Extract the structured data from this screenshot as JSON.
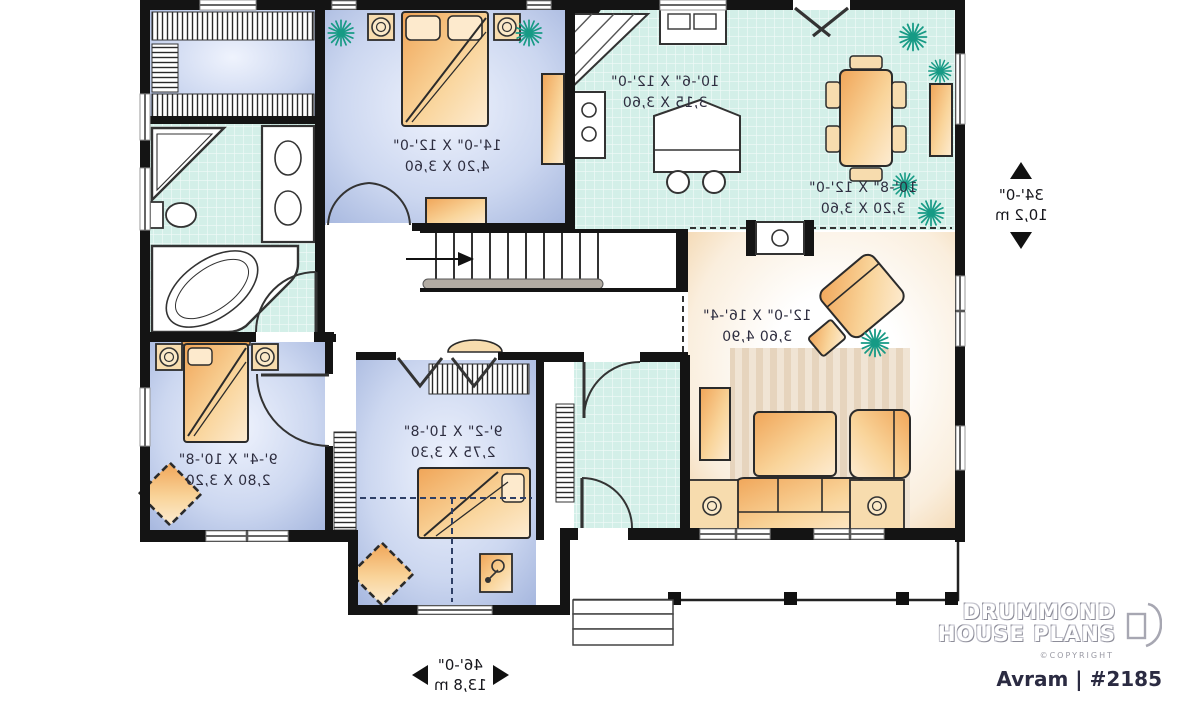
{
  "plan": {
    "brand": {
      "line1": "DRUMMOND",
      "line2": "HOUSE PLANS",
      "copyright": "©COPYRIGHT",
      "model": "Avram | #2185"
    },
    "dimensions": {
      "depth_ft": "34'-0\"",
      "depth_m": "10,2 m",
      "width_ft": "46'-0\"",
      "width_m": "13,8 m"
    },
    "rooms": {
      "master_bedroom": {
        "imperial": "14'-0\" X 12'-0\"",
        "metric": "4,20 X 3,60"
      },
      "kitchen": {
        "imperial": "10'-6\" X 12'-0\"",
        "metric": "3,15 X 3,60"
      },
      "dining": {
        "imperial": "10'-8\" X 12'-0\"",
        "metric": "3,20 X 3,60"
      },
      "living": {
        "imperial": "12'-0\" X 16'-4\"",
        "metric": "3,60 4,90"
      },
      "bedroom2": {
        "imperial": "9'-4\" X 10'-8\"",
        "metric": "2,80 X 3,20"
      },
      "bedroom3": {
        "imperial": "9'-2\" X 10'-8\"",
        "metric": "2,75 X 3,30"
      }
    },
    "colors": {
      "wall": "#141414",
      "bedroom_floor": "#b9c6e8",
      "tile_floor": "#d3efe8",
      "wood_furniture": "#f2b066",
      "living_floor": "#f7e6cc",
      "plant": "#169a85"
    }
  }
}
